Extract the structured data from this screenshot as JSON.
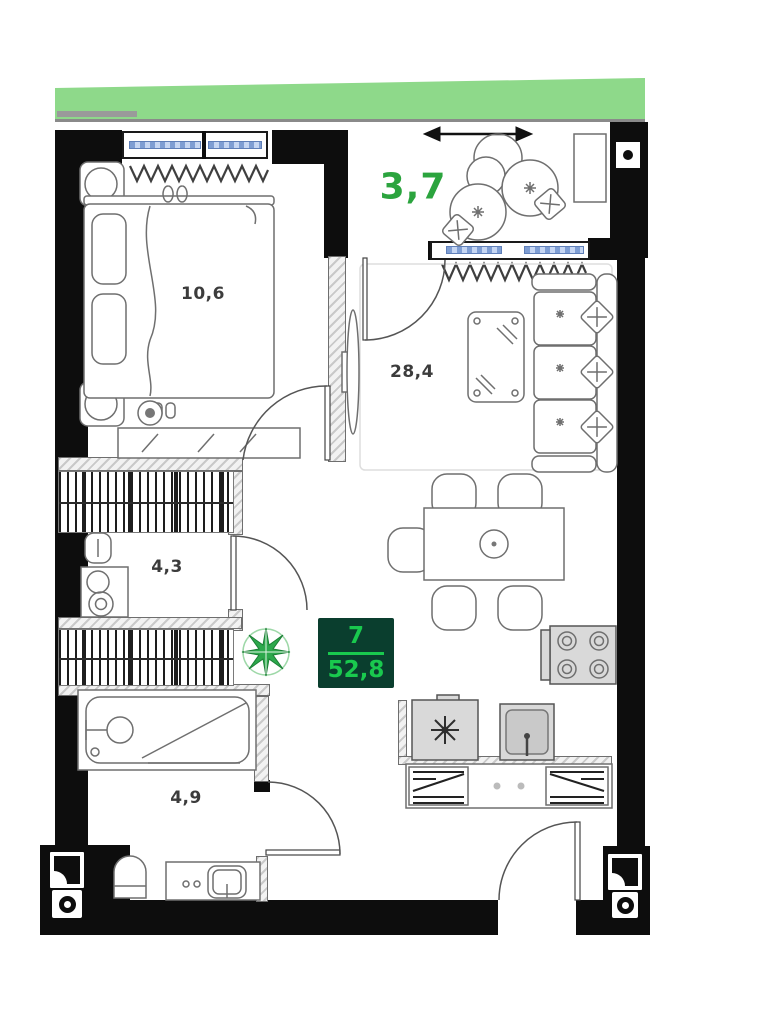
{
  "plan": {
    "unit": {
      "number": "7",
      "total_area": "52,8"
    },
    "rooms": [
      {
        "id": "balcony",
        "area": "3,7"
      },
      {
        "id": "bedroom",
        "area": "10,6"
      },
      {
        "id": "living-room",
        "area": "28,4"
      },
      {
        "id": "wc",
        "area": "4,3"
      },
      {
        "id": "bathroom",
        "area": "4,9"
      }
    ],
    "colors": {
      "facade_green": "#8ed98a",
      "area_label_green": "#2ba43e",
      "badge_background": "#0a3e2e",
      "badge_text_green": "#19c94e",
      "wall_black": "#0d0d0d",
      "window_glazing_blue": "#9db8e4"
    },
    "icons": {
      "compass": "compass-rose-icon",
      "fridge": "snowflake-icon",
      "column_markers": "column-marker-icon",
      "balcony_arrow": "double-arrow-icon"
    }
  }
}
